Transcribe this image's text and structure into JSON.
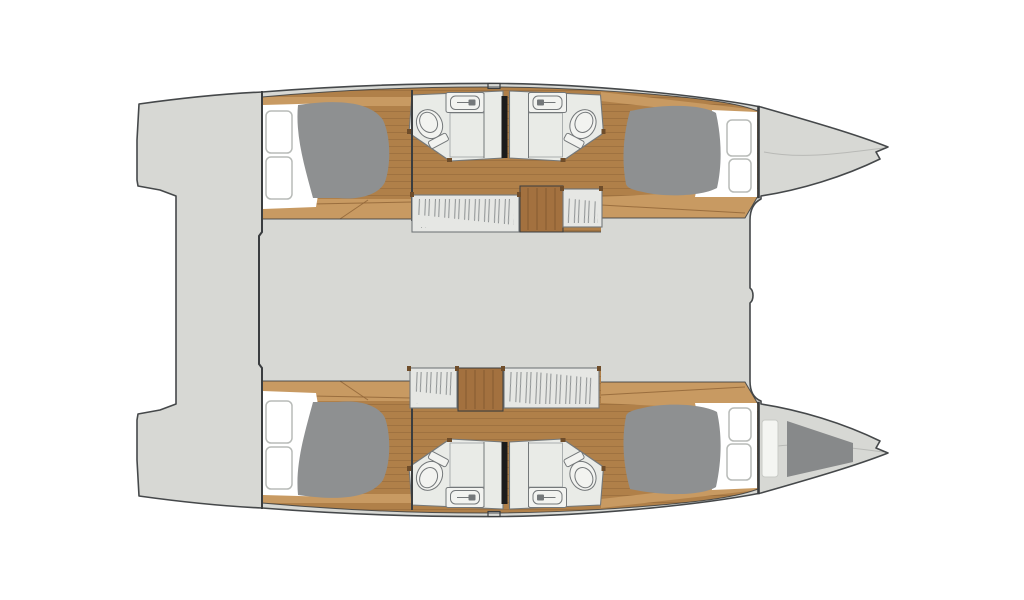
{
  "page": {
    "background": "#ffffff",
    "description": "Catamaran sailing yacht interior deck plan, overhead view, bow pointing right"
  },
  "colors": {
    "background": "#ffffff",
    "deck": "#d7d8d4",
    "outline": "#45484a",
    "wall": "#3a3d3f",
    "wood": "#b08049",
    "wood_light": "#c89a62",
    "wood_dark": "#a3713f",
    "plank": "#8f6336",
    "mattress": "#8e9091",
    "linen": "#ffffff",
    "pillow_edge": "#b8bbb8",
    "bathroom_floor": "#e9ebe7",
    "fixture": "#f2f3f0",
    "fixture_line": "#74787a",
    "grate": "#9aa0a2",
    "wardrobe": "#e6e7e4",
    "hatch": "#8d9192",
    "divider": "#1b1b1b",
    "bow_shade": "#87898a",
    "post": "#6f4d2a",
    "shelf": "#f4f5f2",
    "shelf_edge": "#c8cac6"
  },
  "layout": {
    "vessel": "catamaran",
    "view": "overhead floor plan",
    "bow_direction": "right",
    "hulls": [
      {
        "name": "port hull (top)",
        "compartments": [
          "aft double cabin with berth and two pillows",
          "aft bathroom with shower grate, toilet and washbasin",
          "forward bathroom with shower grate, toilet and washbasin",
          "forward double cabin with berth and two pillows"
        ],
        "furniture": [
          "two hanging wardrobes",
          "companionway steps"
        ]
      },
      {
        "name": "starboard hull (bottom)",
        "compartments": [
          "aft double cabin with berth and two pillows",
          "aft bathroom with shower grate, toilet and washbasin",
          "forward bathroom with shower grate, toilet and washbasin",
          "forward double cabin with berth and two pillows"
        ],
        "furniture": [
          "two hanging wardrobes",
          "companionway steps",
          "forepeak berth cushion in bow"
        ]
      }
    ],
    "shared": [
      "central bridge deck between hulls",
      "twin stern transom platforms",
      "two pointed bows with anchor fittings"
    ]
  }
}
